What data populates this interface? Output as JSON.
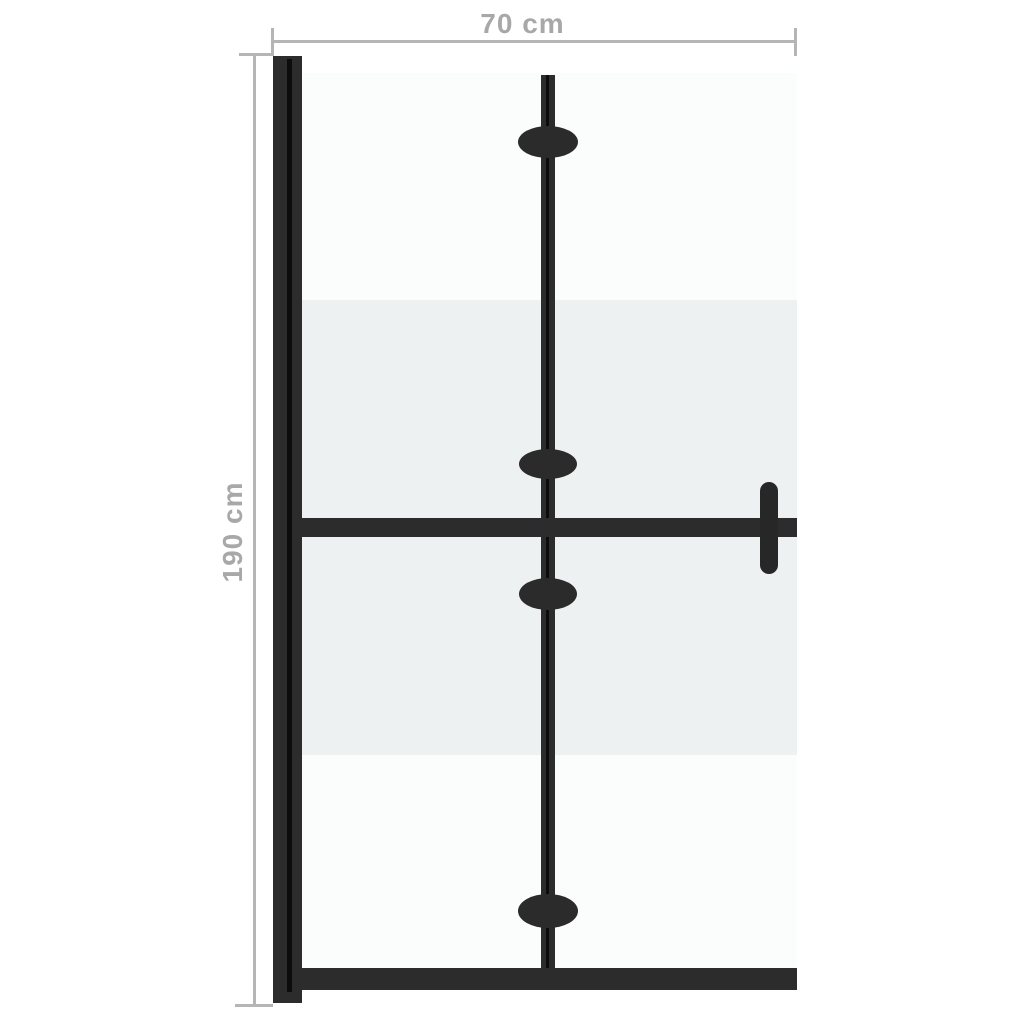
{
  "page": {
    "background": "#ffffff",
    "kind": "product-dimension-diagram",
    "subject": "foldable walk-in shower wall with half-frosted glass"
  },
  "annotations": {
    "width_label": "70 cm",
    "height_label": "190 cm",
    "line_color": "#b5b5b5",
    "text_color": "#a8a8a8"
  },
  "product": {
    "frame_color": "#2c2c2c",
    "seam_color": "#0c0c0c",
    "glass_clear_color": "#fbfdfd",
    "glass_frosted_color": "#edf1f1",
    "handle_color": "#272727",
    "hinge_count": 4,
    "parts": {
      "wall_profile": "left wall-mount profile",
      "glass_panel": "glass panel with frosted middle band",
      "fold_line": "central vertical fold joint",
      "hinges": "oval fold hinges",
      "crossbar": "horizontal stabiliser bar",
      "handle": "wall bracket handle on right",
      "bottom_rail": "bottom frame rail"
    }
  }
}
